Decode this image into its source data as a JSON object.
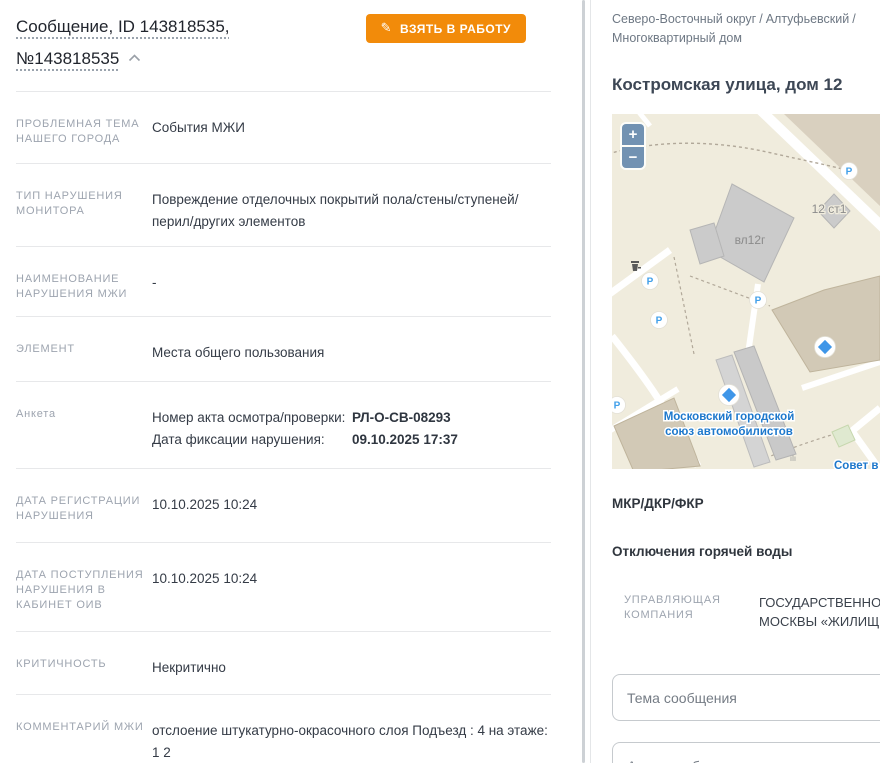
{
  "colors": {
    "accent_orange": "#F28B0A",
    "map_label_blue": "#1D78CC",
    "map_marker_blue": "#3F96E8"
  },
  "left_panel": {
    "title_line1": "Сообщение, ID 143818535,",
    "title_line2": "№143818535",
    "take_button_label": "ВЗЯТЬ В РАБОТУ",
    "pencil_icon": "✎",
    "fields": [
      {
        "label": "ПРОБЛЕМНАЯ ТЕМА НАШЕГО ГОРОДА",
        "value": "События МЖИ"
      },
      {
        "label": "ТИП НАРУШЕНИЯ МОНИТОРА",
        "value": "Повреждение отделочных покрытий пола/стены/ступеней/перил/​других элементов"
      },
      {
        "label": "НАИМЕНОВАНИЕ НАРУШЕНИЯ МЖИ",
        "value": "-"
      },
      {
        "label": "ЭЛЕМЕНТ",
        "value": "Места общего пользования"
      },
      {
        "label": "ДАТА РЕГИСТРАЦИИ НАРУШЕНИЯ",
        "value": "10.10.2025 10:24"
      },
      {
        "label": "ДАТА ПОСТУПЛЕНИЯ НАРУШЕНИЯ В КАБИНЕТ ОИВ",
        "value": "10.10.2025 10:24"
      },
      {
        "label": "КРИТИЧНОСТЬ",
        "value": "Некритично"
      },
      {
        "label": "КОММЕНТАРИЙ МЖИ",
        "value": "отслоение штукатурно-окрасочного слоя Подъезд : 4 на этаже: 1 2"
      }
    ],
    "anketa": {
      "label": "Анкета",
      "rows": [
        {
          "key": "Номер акта осмотра/проверки:",
          "value": "РЛ-О-СВ-08293"
        },
        {
          "key": "Дата фиксации нарушения:",
          "value": "09.10.2025 17:37"
        }
      ]
    }
  },
  "right_panel": {
    "breadcrumb": {
      "items": [
        "Северо-Восточный округ",
        "Алтуфьевский",
        "Многоквартирный дом"
      ],
      "separator": "/"
    },
    "title": "Костромская улица, дом 12",
    "map": {
      "zoom_in": "+",
      "zoom_out": "−",
      "building_label_main": "вл12г",
      "building_label_small": "12 ст1",
      "poi_label_line1": "Московский городской",
      "poi_label_line2": "союз автомобилистов",
      "corner_label": "Совет в",
      "parking_label": "P",
      "vents_label": "ılı"
    },
    "section_mkr": "МКР/ДКР/ФКР",
    "section_hot_water": "Отключения горячей воды",
    "management_company": {
      "label_line1": "УПРАВЛЯЮЩАЯ",
      "label_line2": "КОМПАНИЯ",
      "value_line1": "ГОСУДАРСТВЕННОЕ",
      "value_line2": "МОСКВЫ «ЖИЛИЩН"
    },
    "form": {
      "topic_placeholder": "Тема сообщения",
      "author_placeholder": "Автор сообщения"
    }
  }
}
